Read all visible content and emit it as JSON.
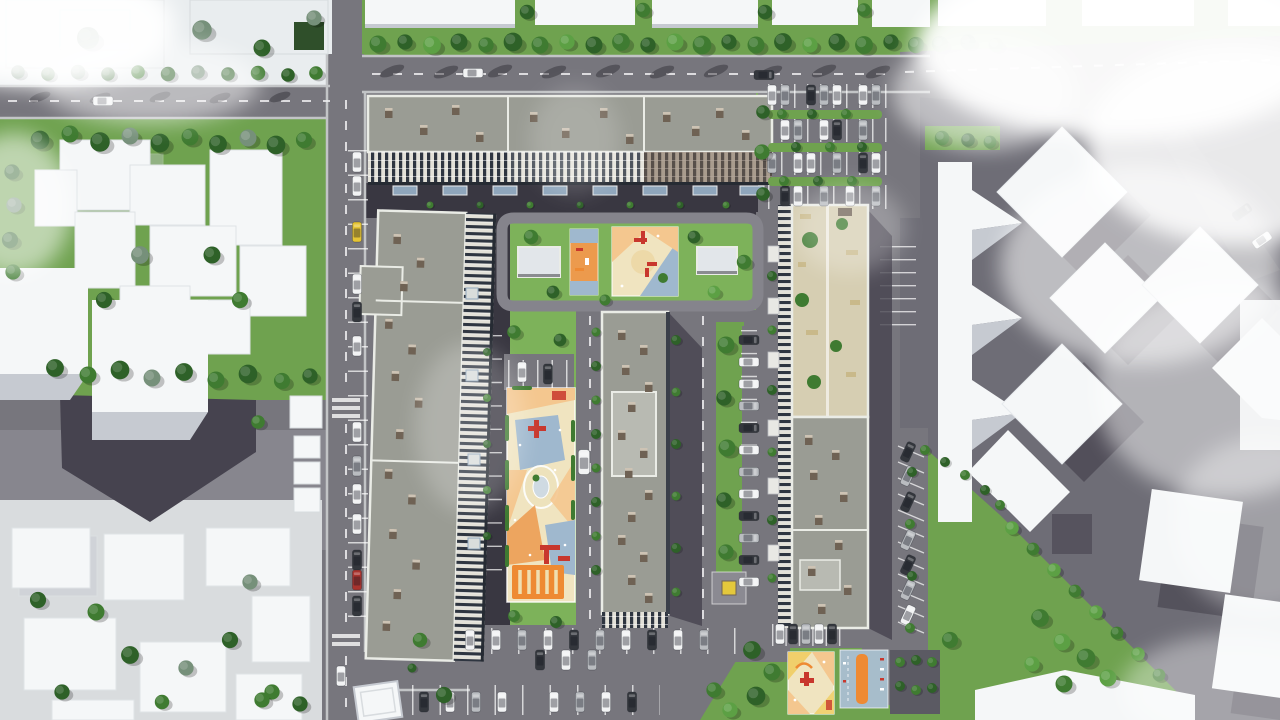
{
  "meta": {
    "description": "Top-down 3D aerial architectural rendering of a residential complex: four apartment slabs around landscaped courtyards with playgrounds, parking lots with cars, tree-lined streets, abstract white massing buildings of the surrounding context, and soft clouds over the corners.",
    "contains_text": false
  },
  "palette": {
    "asphalt": "#77767D",
    "asphaltDark": "#5B5A63",
    "asphaltDrive": "#393741",
    "roadLine": "#EDEDEF",
    "sidewalk": "#C2C4C6",
    "grass": "#6FA24F",
    "grassBright": "#7DB25A",
    "grassDark": "#3F7A31",
    "treeDark": "#2E6128",
    "treeMid": "#3F7B31",
    "treeLight": "#5CA044",
    "treeGray": "#76907A",
    "roofGray": "#9A9C94",
    "roofLight": "#B8BAB2",
    "parapet": "#EAECE6",
    "roofBox": "#6F6254",
    "roofBoxTop": "#CDC3B4",
    "facadeLight": "#E3E1D8",
    "facadeDark": "#2E3540",
    "facadeBrown": "#7A6452",
    "terrace": "#D6CEB2",
    "whiteBld": "#F5F7F8",
    "whiteBldShade": "#E2E6EA",
    "whiteBldGray": "#C6CAD1",
    "shadow": "#46434F",
    "pgBeige": "#F0E4C0",
    "pgPeach": "#F4C78F",
    "pgOrange": "#EC9A4D",
    "pgOrangeDeep": "#EE8A33",
    "pgYellow": "#F0CF6B",
    "pgBlue": "#9FB8CE",
    "pgBlueCourt": "#A7BDCB",
    "equipRed": "#C8372D",
    "carWhite": "#F2F3F4",
    "carSilver": "#B9BCC0",
    "carDark": "#34373D",
    "carYellow": "#E5C435",
    "carRed": "#A8332E",
    "canopyBlue": "#8FA6BC",
    "utilYellow": "#E4C83C",
    "cloud": "#FFFFFF"
  },
  "scene": {
    "central_complex": {
      "apartment_slabs": 4,
      "courtyard_playgrounds": 3,
      "sports_courts": 2,
      "courtyard_kiosks": 2,
      "roof_terrace_garden": 1
    },
    "context": {
      "white_massing_clusters": [
        "north-row",
        "west-block",
        "west-towers",
        "southwest-lowrise",
        "east-zigzag",
        "east-cubes",
        "southeast-slab"
      ],
      "clouds": [
        "top-left",
        "top-right",
        "east-side",
        "center-wisps"
      ]
    },
    "vehicles": {
      "parked_cars_approx": 60,
      "moving_cars": 5,
      "van": 1,
      "taxi": 1
    }
  }
}
